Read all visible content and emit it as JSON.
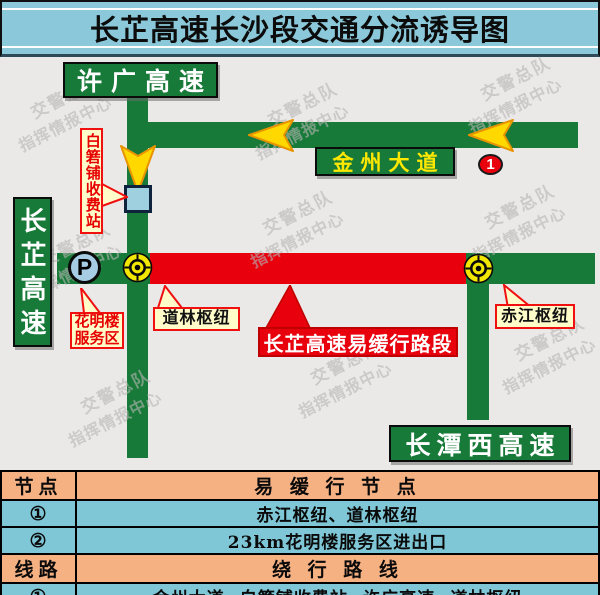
{
  "title": "长芷高速长沙段交通分流诱导图",
  "map": {
    "signs": {
      "xuguang": "许广高速",
      "jinzhou_avenue": "金州大道",
      "changzhi": "长芷高速",
      "changtanxi": "长潭西高速"
    },
    "callouts": {
      "tollgate": "白箬铺收费站",
      "service_area_line1": "花明楼",
      "service_area_line2": "服务区",
      "daolin": "道林枢纽",
      "chijiang": "赤江枢纽",
      "slow_section": "长芷高速易缓行路段"
    },
    "markers": {
      "node1": "1",
      "parking": "P"
    },
    "watermark": {
      "line1": "交警总队",
      "line2": "指挥情报中心"
    }
  },
  "table": {
    "rows": [
      {
        "col1": "节点",
        "col2": "易 缓 行 节 点"
      },
      {
        "col1": "①",
        "col2": "赤江枢纽、道林枢纽"
      },
      {
        "col1": "②",
        "col2": "23km花明楼服务区进出口"
      },
      {
        "col1": "线路",
        "col2": "绕 行 路 线"
      },
      {
        "col1": "①",
        "col2": "金州大道↔白箬铺收费站↔许广高速↔道林枢纽"
      }
    ]
  },
  "colors": {
    "title_bg": "#8BC9DA",
    "road_green": "#187A39",
    "slow_red": "#E8000D",
    "arrow_yellow": "#FFD800",
    "bullseye_yellow": "#F2E700",
    "table_orange": "#F6B183",
    "table_blue": "#7FC7D7",
    "callout_cream": "#FFFCC9",
    "marker_blue": "#A6CDE4"
  }
}
